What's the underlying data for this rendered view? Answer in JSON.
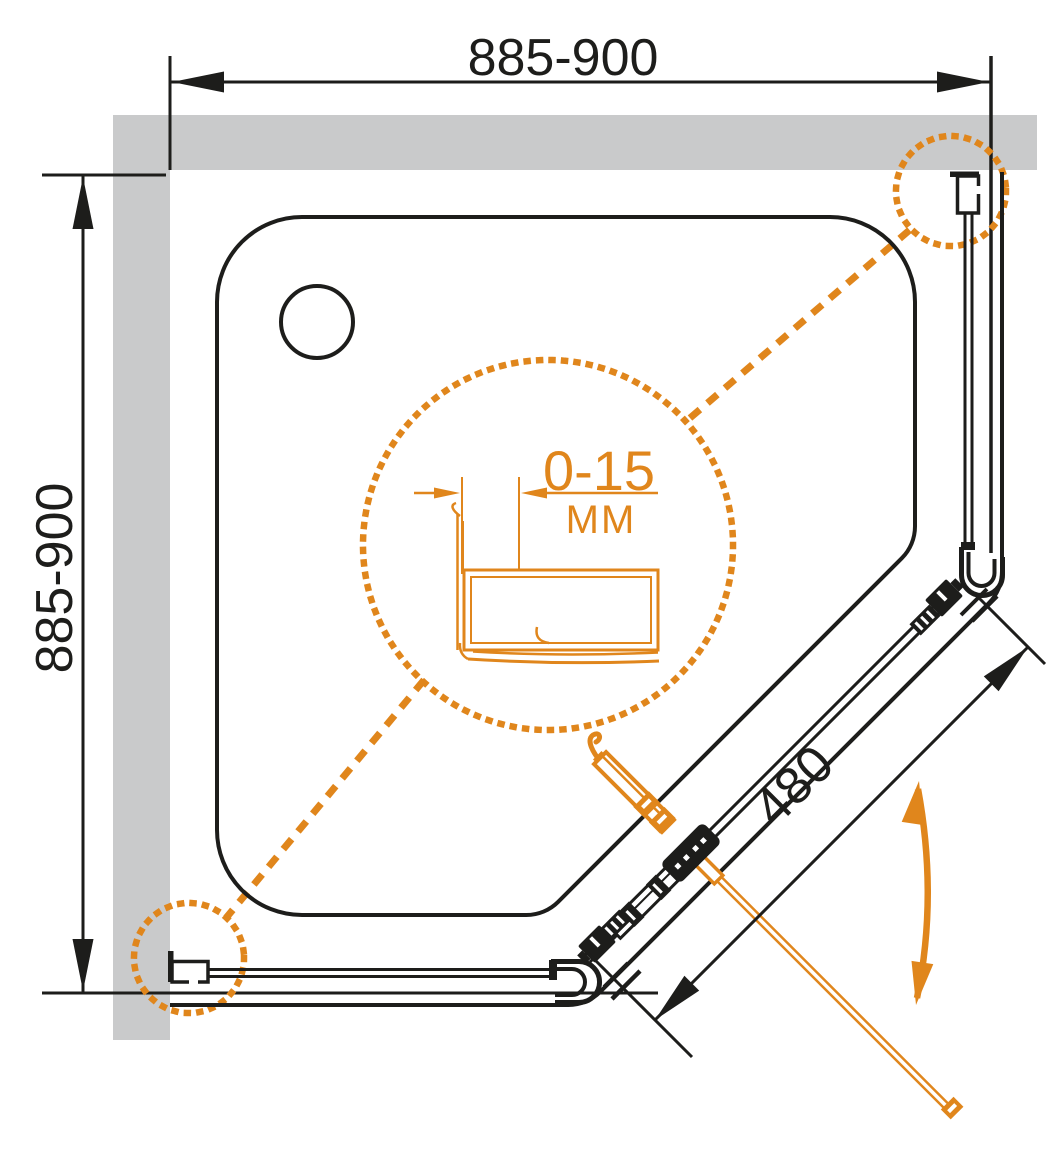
{
  "drawing": {
    "type": "technical-installation-diagram",
    "subject": "pentagonal corner shower enclosure, top view",
    "dimensions": {
      "width_label": "885-900",
      "depth_label": "885-900",
      "door_label": "480",
      "adjustment_range": "0-15",
      "adjustment_unit": "ММ"
    },
    "colors": {
      "line": "#1d1d1b",
      "accent": "#e0861c",
      "wall": "#c9cacb",
      "background": "#ffffff"
    },
    "icons": [
      "detail-circle-center",
      "detail-callout-top-right",
      "detail-callout-bottom-left",
      "door-swing-arrow",
      "drain-circle"
    ]
  }
}
